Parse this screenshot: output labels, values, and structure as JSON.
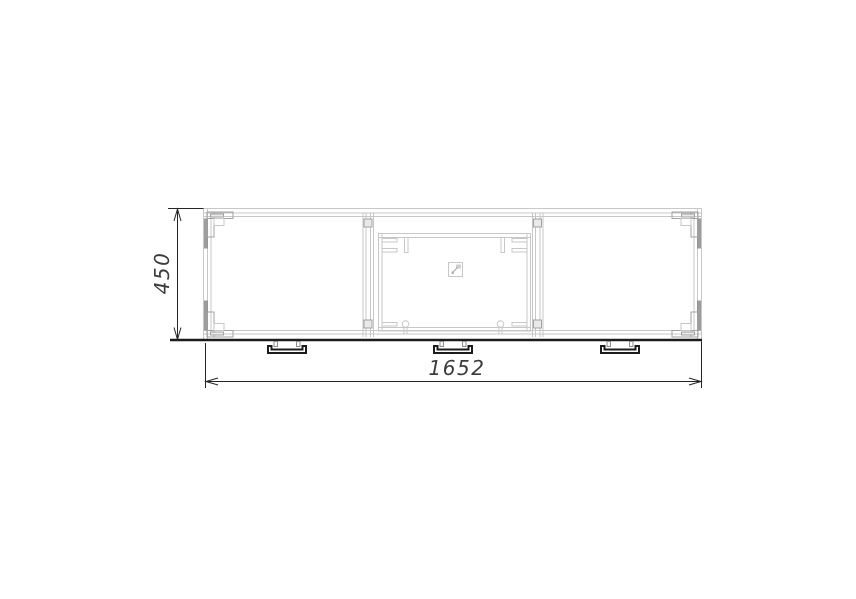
{
  "drawing": {
    "dimensions": {
      "height_label": "450",
      "width_label": "1652"
    },
    "section_count": 3,
    "feet_count": 3
  },
  "colors": {
    "background": "#ffffff",
    "line_light": "#c7c7c7",
    "line_medium": "#a2a2a2",
    "line_dark_gray": "#8c8c8c",
    "fill_light": "#e9e9e9",
    "dimension_line": "#262626",
    "dimension_text": "#3c3c3c",
    "foot_outline": "#1c1c1c"
  }
}
